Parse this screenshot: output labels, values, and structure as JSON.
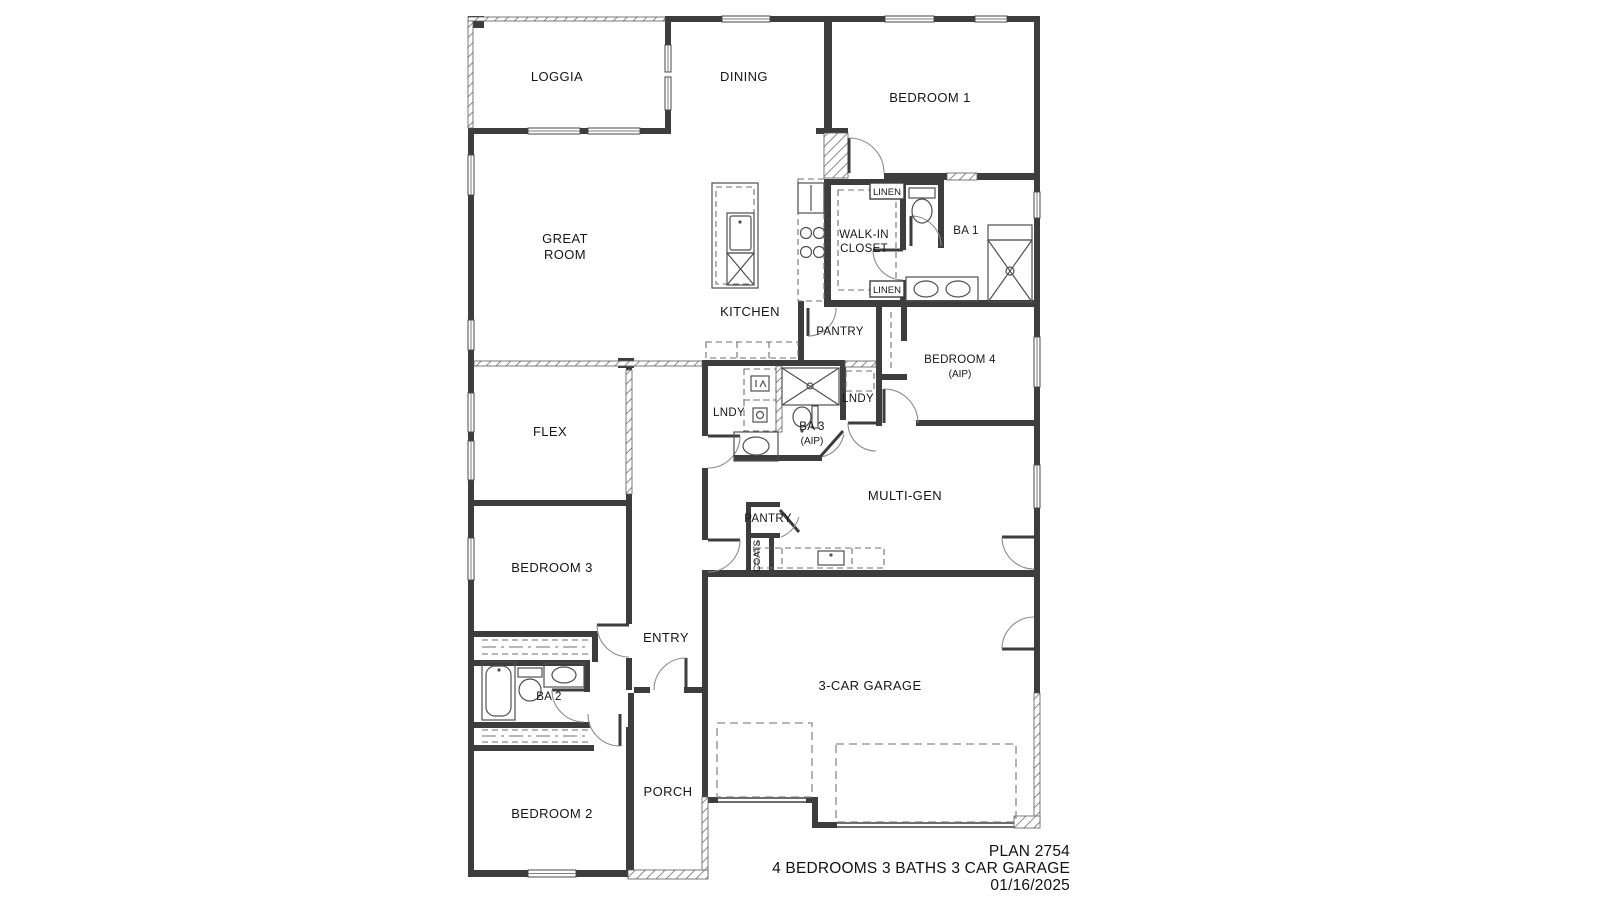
{
  "title_block": {
    "plan": "PLAN 2754",
    "specs": "4 BEDROOMS 3 BATHS 3 CAR GARAGE",
    "date": "01/16/2025"
  },
  "rooms": {
    "loggia": "LOGGIA",
    "dining": "DINING",
    "bedroom1": "BEDROOM 1",
    "great_room_line1": "GREAT",
    "great_room_line2": "ROOM",
    "kitchen": "KITCHEN",
    "flex": "FLEX",
    "multi_gen": "MULTI-GEN",
    "bedroom3": "BEDROOM 3",
    "entry": "ENTRY",
    "garage": "3-CAR GARAGE",
    "porch": "PORCH",
    "bedroom2": "BEDROOM 2",
    "bedroom4": "BEDROOM 4",
    "bedroom4_note": "(AIP)",
    "walk_in_closet_line1": "WALK-IN",
    "walk_in_closet_line2": "CLOSET",
    "bath1": "BA 1",
    "bath2": "BA 2",
    "bath3": "BA 3",
    "bath3_note": "(AIP)",
    "laundry": "LNDY",
    "laundry_opt": "LNDY",
    "pantry_kitchen": "PANTRY",
    "pantry_multigen": "PANTRY",
    "coats": "COATS",
    "linen_upper": "LINEN",
    "linen_lower": "LINEN"
  }
}
